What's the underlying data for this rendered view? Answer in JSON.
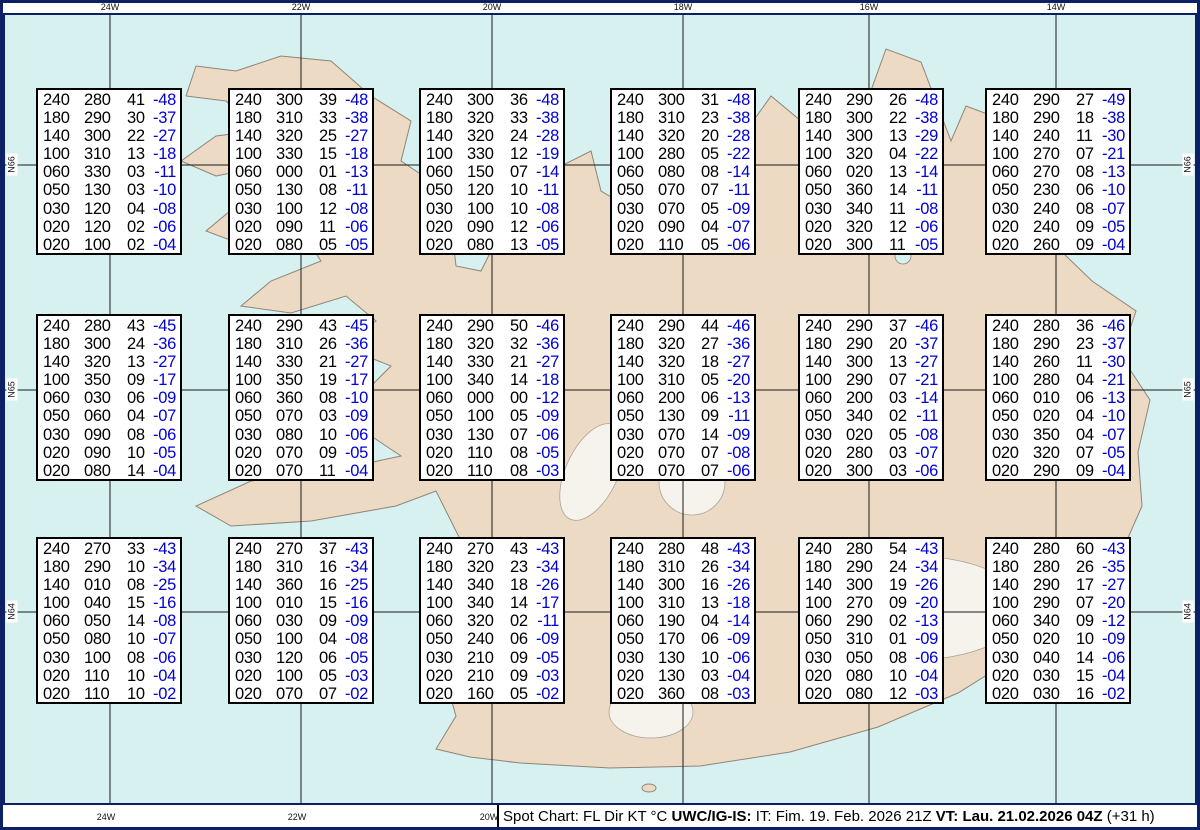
{
  "map": {
    "colors": {
      "water": "#d7f0f0",
      "land": "#ecdac4",
      "frame_navy": "#0c2066",
      "temp_blue": "#0000d6",
      "grid": "#1a1a1a"
    },
    "meridians": [
      {
        "x": 110,
        "label": "24W"
      },
      {
        "x": 301,
        "label": "22W"
      },
      {
        "x": 492,
        "label": "20W"
      },
      {
        "x": 683,
        "label": "18W"
      },
      {
        "x": 869,
        "label": "16W"
      },
      {
        "x": 1056,
        "label": "14W"
      }
    ],
    "bottom_labels": [
      {
        "x": 106,
        "text": "24W"
      },
      {
        "x": 297,
        "text": "22W"
      },
      {
        "x": 489,
        "text": "20W"
      }
    ],
    "parallels": [
      {
        "y": 165,
        "label": "N66"
      },
      {
        "y": 390,
        "label": "N65"
      },
      {
        "y": 612,
        "label": "N64"
      }
    ]
  },
  "column_meaning": [
    "FL",
    "Dir",
    "KT",
    "degC"
  ],
  "boxes": [
    {
      "x": 36,
      "y": 88,
      "rows": [
        [
          "240",
          "280",
          "41",
          "-48"
        ],
        [
          "180",
          "290",
          "30",
          "-37"
        ],
        [
          "140",
          "300",
          "22",
          "-27"
        ],
        [
          "100",
          "310",
          "13",
          "-18"
        ],
        [
          "060",
          "330",
          "03",
          "-11"
        ],
        [
          "050",
          "130",
          "03",
          "-10"
        ],
        [
          "030",
          "120",
          "04",
          "-08"
        ],
        [
          "020",
          "120",
          "02",
          "-06"
        ],
        [
          "020",
          "100",
          "02",
          "-04"
        ]
      ]
    },
    {
      "x": 228,
      "y": 88,
      "rows": [
        [
          "240",
          "300",
          "39",
          "-48"
        ],
        [
          "180",
          "310",
          "33",
          "-38"
        ],
        [
          "140",
          "320",
          "25",
          "-27"
        ],
        [
          "100",
          "330",
          "15",
          "-18"
        ],
        [
          "060",
          "000",
          "01",
          "-13"
        ],
        [
          "050",
          "130",
          "08",
          "-11"
        ],
        [
          "030",
          "100",
          "12",
          "-08"
        ],
        [
          "020",
          "090",
          "11",
          "-06"
        ],
        [
          "020",
          "080",
          "05",
          "-05"
        ]
      ]
    },
    {
      "x": 419,
      "y": 88,
      "rows": [
        [
          "240",
          "300",
          "36",
          "-48"
        ],
        [
          "180",
          "320",
          "33",
          "-38"
        ],
        [
          "140",
          "320",
          "24",
          "-28"
        ],
        [
          "100",
          "330",
          "12",
          "-19"
        ],
        [
          "060",
          "150",
          "07",
          "-14"
        ],
        [
          "050",
          "120",
          "10",
          "-11"
        ],
        [
          "030",
          "100",
          "10",
          "-08"
        ],
        [
          "020",
          "090",
          "12",
          "-06"
        ],
        [
          "020",
          "080",
          "13",
          "-05"
        ]
      ]
    },
    {
      "x": 610,
      "y": 88,
      "rows": [
        [
          "240",
          "300",
          "31",
          "-48"
        ],
        [
          "180",
          "310",
          "23",
          "-38"
        ],
        [
          "140",
          "320",
          "20",
          "-28"
        ],
        [
          "100",
          "280",
          "05",
          "-22"
        ],
        [
          "060",
          "080",
          "08",
          "-14"
        ],
        [
          "050",
          "070",
          "07",
          "-11"
        ],
        [
          "030",
          "070",
          "05",
          "-09"
        ],
        [
          "020",
          "090",
          "04",
          "-07"
        ],
        [
          "020",
          "110",
          "05",
          "-06"
        ]
      ]
    },
    {
      "x": 798,
      "y": 88,
      "rows": [
        [
          "240",
          "290",
          "26",
          "-48"
        ],
        [
          "180",
          "300",
          "22",
          "-38"
        ],
        [
          "140",
          "300",
          "13",
          "-29"
        ],
        [
          "100",
          "320",
          "04",
          "-22"
        ],
        [
          "060",
          "020",
          "13",
          "-14"
        ],
        [
          "050",
          "360",
          "14",
          "-11"
        ],
        [
          "030",
          "340",
          "11",
          "-08"
        ],
        [
          "020",
          "320",
          "12",
          "-06"
        ],
        [
          "020",
          "300",
          "11",
          "-05"
        ]
      ]
    },
    {
      "x": 985,
      "y": 88,
      "rows": [
        [
          "240",
          "290",
          "27",
          "-49"
        ],
        [
          "180",
          "290",
          "18",
          "-38"
        ],
        [
          "140",
          "240",
          "11",
          "-30"
        ],
        [
          "100",
          "270",
          "07",
          "-21"
        ],
        [
          "060",
          "270",
          "08",
          "-13"
        ],
        [
          "050",
          "230",
          "06",
          "-10"
        ],
        [
          "030",
          "240",
          "08",
          "-07"
        ],
        [
          "020",
          "240",
          "09",
          "-05"
        ],
        [
          "020",
          "260",
          "09",
          "-04"
        ]
      ]
    },
    {
      "x": 36,
      "y": 314,
      "rows": [
        [
          "240",
          "280",
          "43",
          "-45"
        ],
        [
          "180",
          "300",
          "24",
          "-36"
        ],
        [
          "140",
          "320",
          "13",
          "-27"
        ],
        [
          "100",
          "350",
          "09",
          "-17"
        ],
        [
          "060",
          "030",
          "06",
          "-09"
        ],
        [
          "050",
          "060",
          "04",
          "-07"
        ],
        [
          "030",
          "090",
          "08",
          "-06"
        ],
        [
          "020",
          "090",
          "10",
          "-05"
        ],
        [
          "020",
          "080",
          "14",
          "-04"
        ]
      ]
    },
    {
      "x": 228,
      "y": 314,
      "rows": [
        [
          "240",
          "290",
          "43",
          "-45"
        ],
        [
          "180",
          "310",
          "26",
          "-36"
        ],
        [
          "140",
          "330",
          "21",
          "-27"
        ],
        [
          "100",
          "350",
          "19",
          "-17"
        ],
        [
          "060",
          "360",
          "08",
          "-10"
        ],
        [
          "050",
          "070",
          "03",
          "-09"
        ],
        [
          "030",
          "080",
          "10",
          "-06"
        ],
        [
          "020",
          "070",
          "09",
          "-05"
        ],
        [
          "020",
          "070",
          "11",
          "-04"
        ]
      ]
    },
    {
      "x": 419,
      "y": 314,
      "rows": [
        [
          "240",
          "290",
          "50",
          "-46"
        ],
        [
          "180",
          "320",
          "32",
          "-36"
        ],
        [
          "140",
          "330",
          "21",
          "-27"
        ],
        [
          "100",
          "340",
          "14",
          "-18"
        ],
        [
          "060",
          "000",
          "00",
          "-12"
        ],
        [
          "050",
          "100",
          "05",
          "-09"
        ],
        [
          "030",
          "130",
          "07",
          "-06"
        ],
        [
          "020",
          "110",
          "08",
          "-05"
        ],
        [
          "020",
          "110",
          "08",
          "-03"
        ]
      ]
    },
    {
      "x": 610,
      "y": 314,
      "rows": [
        [
          "240",
          "290",
          "44",
          "-46"
        ],
        [
          "180",
          "320",
          "27",
          "-36"
        ],
        [
          "140",
          "320",
          "18",
          "-27"
        ],
        [
          "100",
          "310",
          "05",
          "-20"
        ],
        [
          "060",
          "200",
          "06",
          "-13"
        ],
        [
          "050",
          "130",
          "09",
          "-11"
        ],
        [
          "030",
          "070",
          "14",
          "-09"
        ],
        [
          "020",
          "070",
          "07",
          "-08"
        ],
        [
          "020",
          "070",
          "07",
          "-06"
        ]
      ]
    },
    {
      "x": 798,
      "y": 314,
      "rows": [
        [
          "240",
          "290",
          "37",
          "-46"
        ],
        [
          "180",
          "290",
          "20",
          "-37"
        ],
        [
          "140",
          "300",
          "13",
          "-27"
        ],
        [
          "100",
          "290",
          "07",
          "-21"
        ],
        [
          "060",
          "200",
          "03",
          "-14"
        ],
        [
          "050",
          "340",
          "02",
          "-11"
        ],
        [
          "030",
          "020",
          "05",
          "-08"
        ],
        [
          "020",
          "280",
          "03",
          "-07"
        ],
        [
          "020",
          "300",
          "03",
          "-06"
        ]
      ]
    },
    {
      "x": 985,
      "y": 314,
      "rows": [
        [
          "240",
          "280",
          "36",
          "-46"
        ],
        [
          "180",
          "290",
          "23",
          "-37"
        ],
        [
          "140",
          "260",
          "11",
          "-30"
        ],
        [
          "100",
          "280",
          "04",
          "-21"
        ],
        [
          "060",
          "010",
          "06",
          "-13"
        ],
        [
          "050",
          "020",
          "04",
          "-10"
        ],
        [
          "030",
          "350",
          "04",
          "-07"
        ],
        [
          "020",
          "320",
          "07",
          "-05"
        ],
        [
          "020",
          "290",
          "09",
          "-04"
        ]
      ]
    },
    {
      "x": 36,
      "y": 537,
      "rows": [
        [
          "240",
          "270",
          "33",
          "-43"
        ],
        [
          "180",
          "290",
          "10",
          "-34"
        ],
        [
          "140",
          "010",
          "08",
          "-25"
        ],
        [
          "100",
          "040",
          "15",
          "-16"
        ],
        [
          "060",
          "050",
          "14",
          "-08"
        ],
        [
          "050",
          "080",
          "10",
          "-07"
        ],
        [
          "030",
          "100",
          "08",
          "-06"
        ],
        [
          "020",
          "110",
          "10",
          "-04"
        ],
        [
          "020",
          "110",
          "10",
          "-02"
        ]
      ]
    },
    {
      "x": 228,
      "y": 537,
      "rows": [
        [
          "240",
          "270",
          "37",
          "-43"
        ],
        [
          "180",
          "310",
          "16",
          "-34"
        ],
        [
          "140",
          "360",
          "16",
          "-25"
        ],
        [
          "100",
          "010",
          "15",
          "-16"
        ],
        [
          "060",
          "030",
          "09",
          "-09"
        ],
        [
          "050",
          "100",
          "04",
          "-08"
        ],
        [
          "030",
          "120",
          "06",
          "-05"
        ],
        [
          "020",
          "100",
          "05",
          "-03"
        ],
        [
          "020",
          "070",
          "07",
          "-02"
        ]
      ]
    },
    {
      "x": 419,
      "y": 537,
      "rows": [
        [
          "240",
          "270",
          "43",
          "-43"
        ],
        [
          "180",
          "320",
          "23",
          "-34"
        ],
        [
          "140",
          "340",
          "18",
          "-26"
        ],
        [
          "100",
          "340",
          "14",
          "-17"
        ],
        [
          "060",
          "320",
          "02",
          "-11"
        ],
        [
          "050",
          "240",
          "06",
          "-09"
        ],
        [
          "030",
          "210",
          "09",
          "-05"
        ],
        [
          "020",
          "210",
          "09",
          "-03"
        ],
        [
          "020",
          "160",
          "05",
          "-02"
        ]
      ]
    },
    {
      "x": 610,
      "y": 537,
      "rows": [
        [
          "240",
          "280",
          "48",
          "-43"
        ],
        [
          "180",
          "310",
          "26",
          "-34"
        ],
        [
          "140",
          "300",
          "16",
          "-26"
        ],
        [
          "100",
          "310",
          "13",
          "-18"
        ],
        [
          "060",
          "190",
          "04",
          "-14"
        ],
        [
          "050",
          "170",
          "06",
          "-09"
        ],
        [
          "030",
          "130",
          "10",
          "-06"
        ],
        [
          "020",
          "130",
          "03",
          "-04"
        ],
        [
          "020",
          "360",
          "08",
          "-03"
        ]
      ]
    },
    {
      "x": 798,
      "y": 537,
      "rows": [
        [
          "240",
          "280",
          "54",
          "-43"
        ],
        [
          "180",
          "290",
          "24",
          "-34"
        ],
        [
          "140",
          "300",
          "19",
          "-26"
        ],
        [
          "100",
          "270",
          "09",
          "-20"
        ],
        [
          "060",
          "290",
          "02",
          "-13"
        ],
        [
          "050",
          "310",
          "01",
          "-09"
        ],
        [
          "030",
          "050",
          "08",
          "-06"
        ],
        [
          "020",
          "080",
          "10",
          "-04"
        ],
        [
          "020",
          "080",
          "12",
          "-03"
        ]
      ]
    },
    {
      "x": 985,
      "y": 537,
      "rows": [
        [
          "240",
          "280",
          "60",
          "-43"
        ],
        [
          "180",
          "280",
          "26",
          "-35"
        ],
        [
          "140",
          "290",
          "17",
          "-27"
        ],
        [
          "100",
          "290",
          "07",
          "-20"
        ],
        [
          "060",
          "340",
          "09",
          "-12"
        ],
        [
          "050",
          "020",
          "10",
          "-09"
        ],
        [
          "030",
          "040",
          "14",
          "-06"
        ],
        [
          "020",
          "030",
          "15",
          "-04"
        ],
        [
          "020",
          "030",
          "16",
          "-02"
        ]
      ]
    }
  ],
  "statusbar": {
    "prefix": "Spot Chart: FL Dir KT °C ",
    "issuer_bold": "UWC/IG-IS:",
    "issue_time": " IT: Fim. 19. Feb. 2026 21Z ",
    "valid_time_bold": "VT: Lau. 21.02.2026 04Z",
    "suffix": " (+31 h)"
  }
}
